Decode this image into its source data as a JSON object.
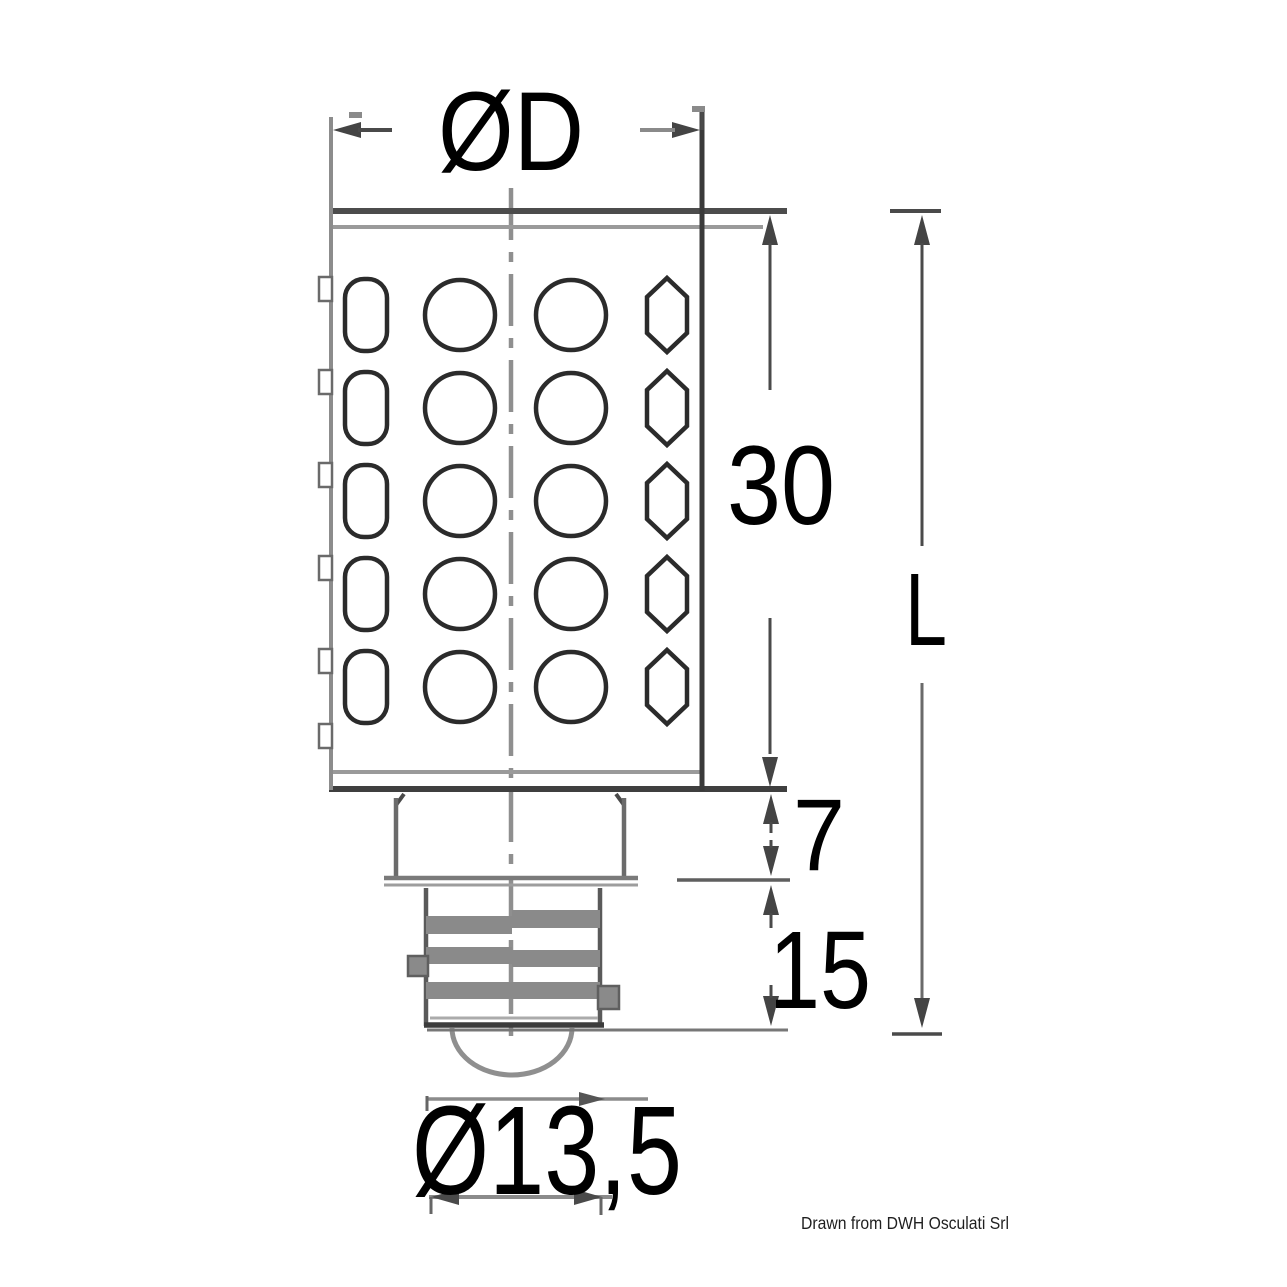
{
  "drawing": {
    "subject": "LED bulb with bayonet base, dimensioned outline drawing",
    "led_grid": {
      "rows": 5,
      "columns": 4
    }
  },
  "labels": {
    "top_diameter": "ØD",
    "body_length": "30",
    "overall_length": "L",
    "neck_length": "7",
    "base_length": "15",
    "base_diameter": "Ø13,5"
  },
  "footer": {
    "credit": "Drawn from DWH Osculati Srl"
  },
  "colors": {
    "line_dark": "#3f3f3f",
    "line_gray": "#8c8c8c",
    "text": "#000000",
    "background": "#ffffff"
  }
}
